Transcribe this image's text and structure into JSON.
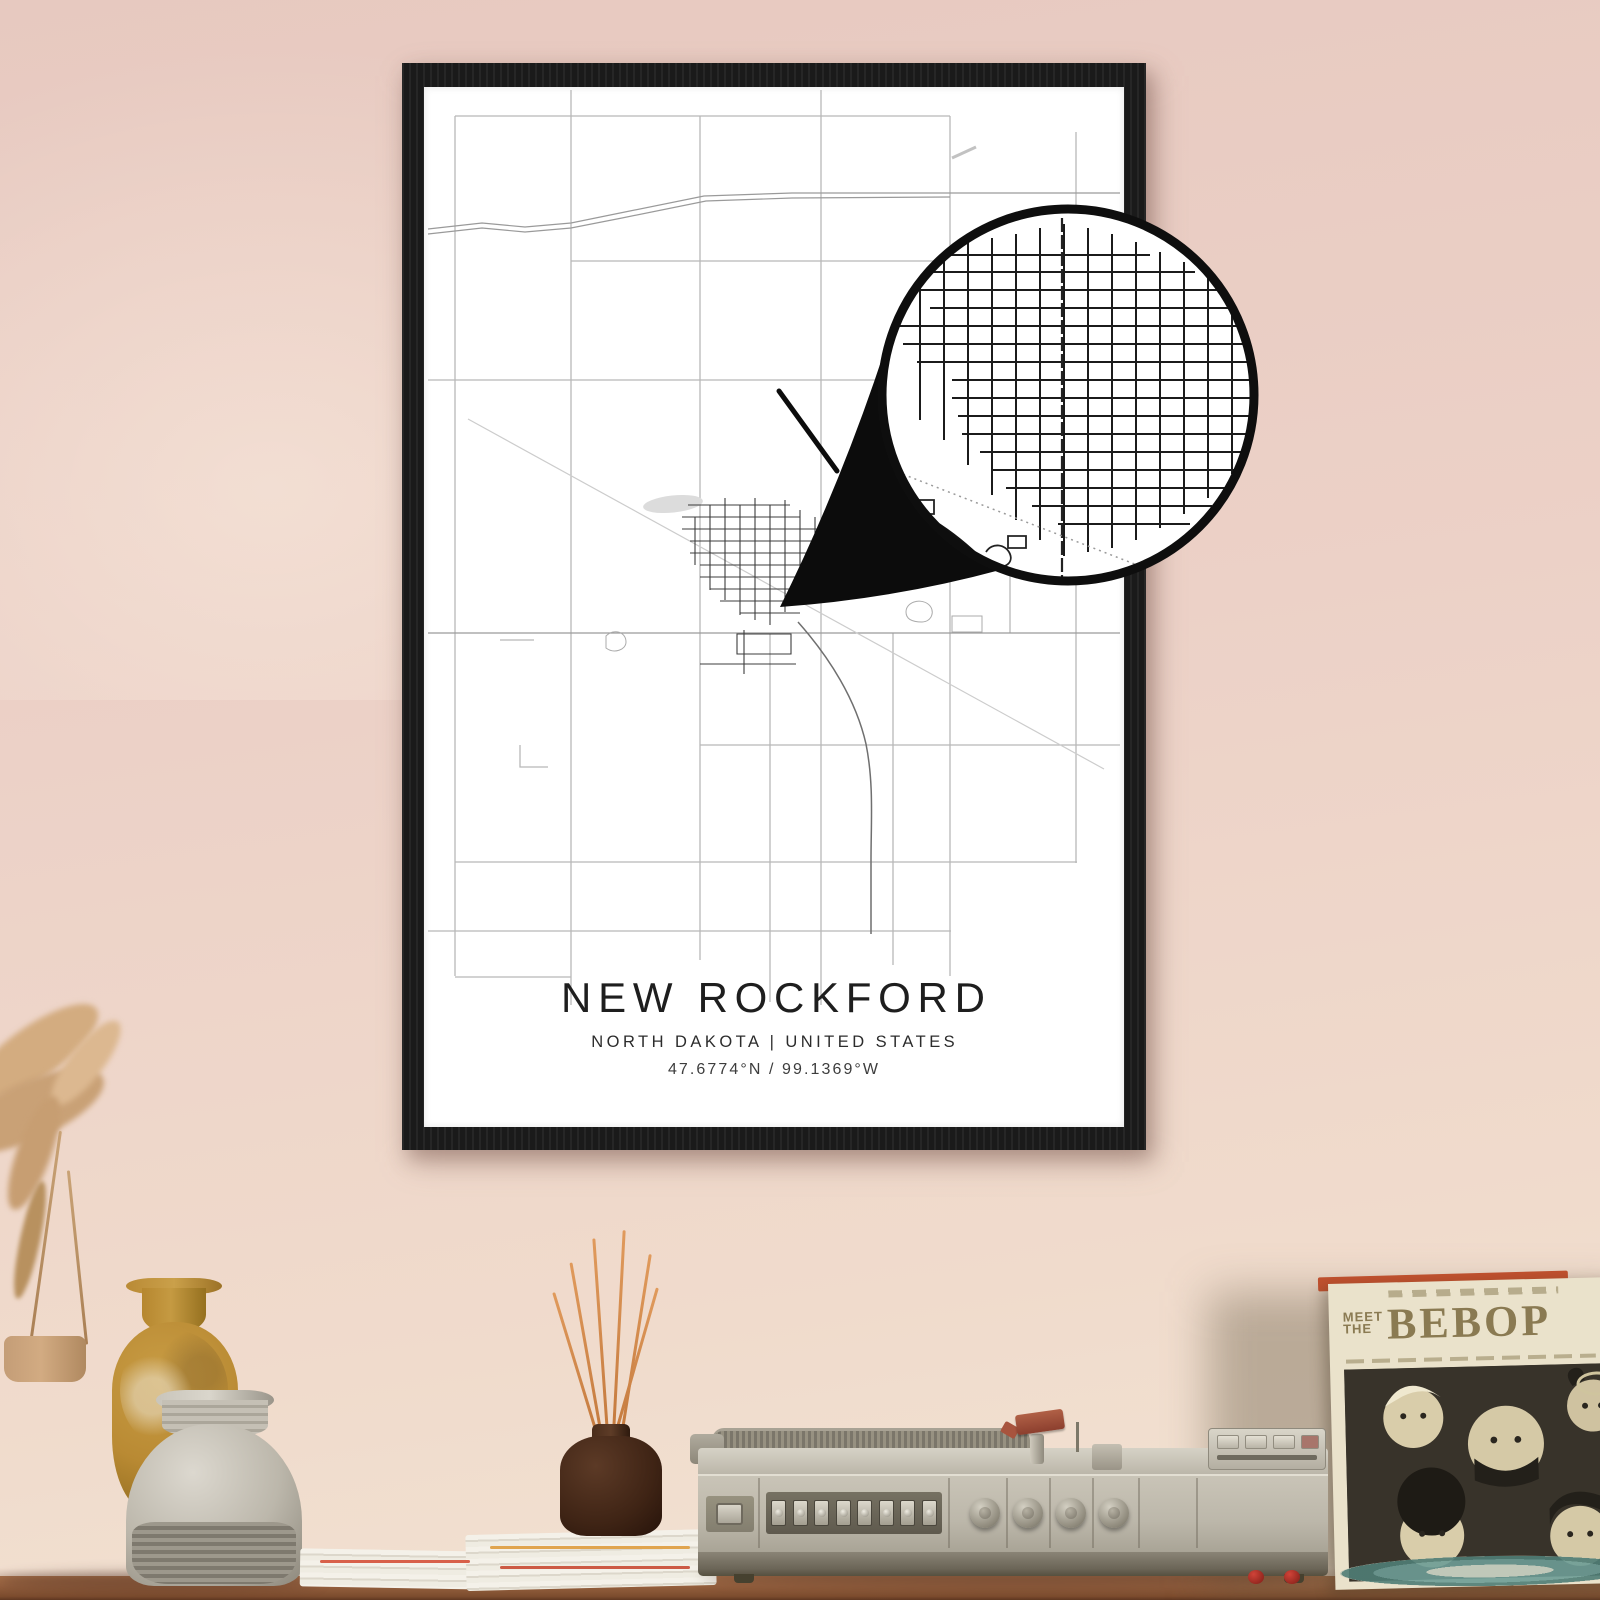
{
  "poster": {
    "title": "NEW ROCKFORD",
    "subtitle": "NORTH DAKOTA | UNITED STATES",
    "coordinates": "47.6774°N / 99.1369°W"
  },
  "record_sleeve": {
    "pretitle_line1": "MEET",
    "pretitle_line2": "THE",
    "title": "BEBOP"
  },
  "colors": {
    "wall": "#ecd1c7",
    "wall_top": "#e7c9c0",
    "wall_bottom": "#f2e3d3",
    "frame": "#1a1a1a",
    "poster_bg": "#ffffff",
    "map_road_light": "#b8b8b8",
    "map_road_dark": "#3c3c3c",
    "magnifier_ink": "#0c0c0c",
    "table": "#96613f",
    "sleeve_bg": "#eae2cb",
    "sleeve_ink": "#8a7a52",
    "sleeve_photo": "#38332a",
    "strip_orange": "#c0512f"
  }
}
